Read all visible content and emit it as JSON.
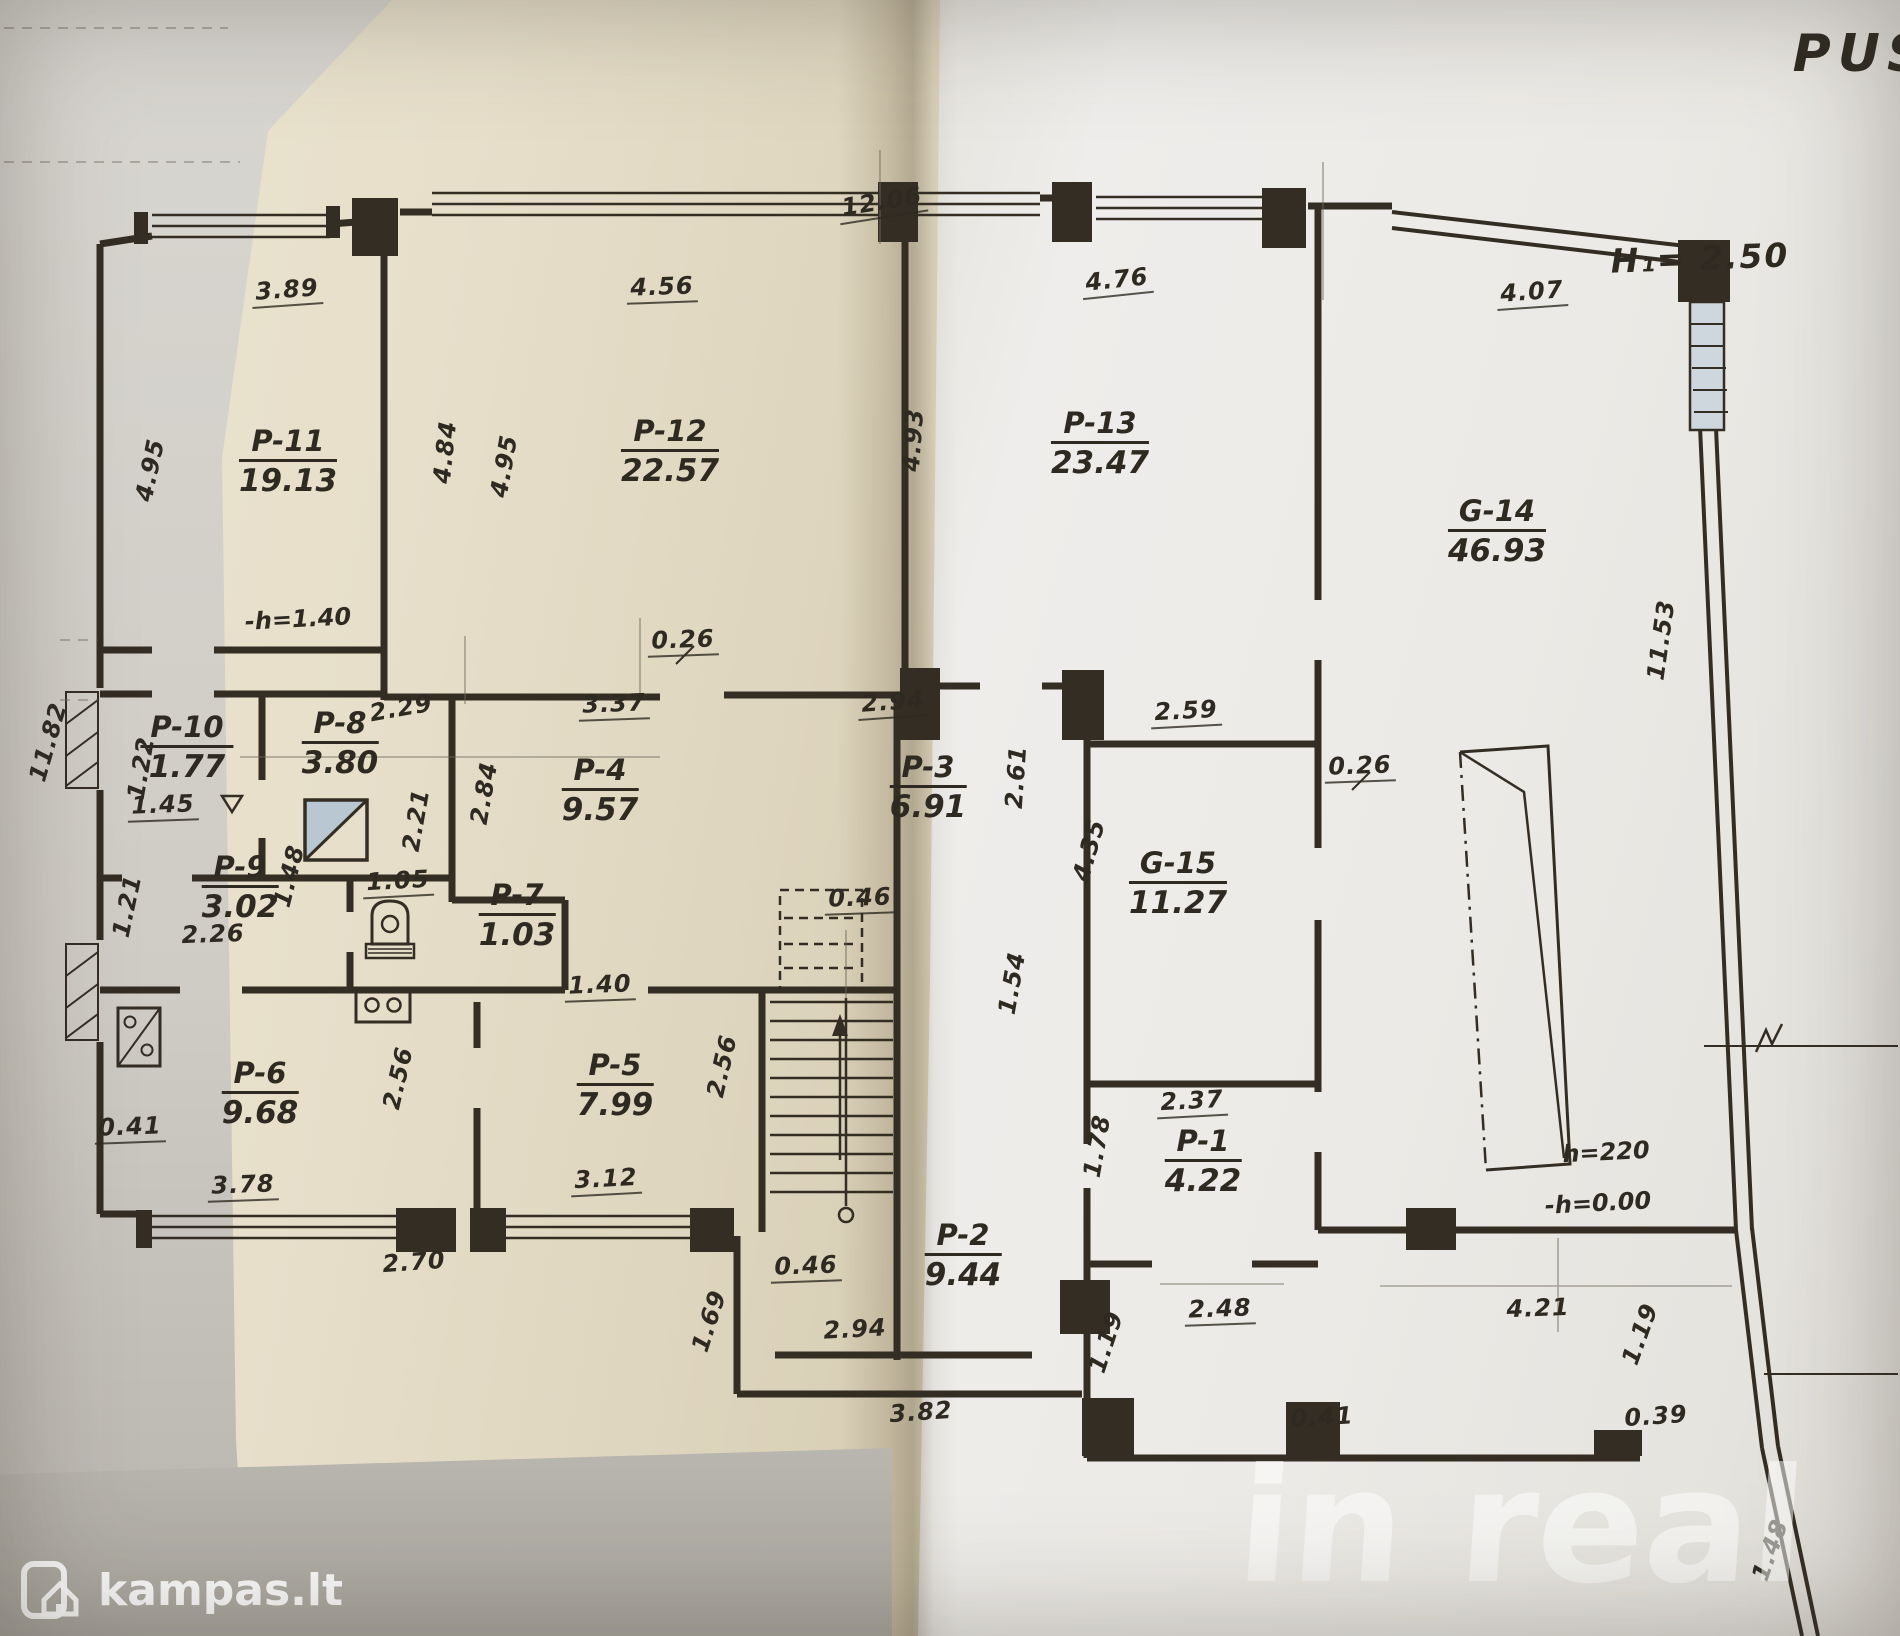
{
  "annotations": [
    {
      "t": "-h=1.40",
      "x": 298,
      "y": 619,
      "r": -3,
      "cls": "mid"
    },
    {
      "t": "h=220",
      "x": 1606,
      "y": 1152,
      "r": -3,
      "cls": "mid"
    },
    {
      "t": "-h=0.00",
      "x": 1598,
      "y": 1203,
      "r": -3,
      "cls": "mid"
    },
    {
      "t": "H₁= 2.50",
      "x": 1700,
      "y": 258,
      "r": -2,
      "cls": "big"
    },
    {
      "t": "PUS",
      "x": 1862,
      "y": 54,
      "r": 0,
      "cls": "title"
    }
  ],
  "rooms": [
    {
      "name": "P-11",
      "area": "19.13",
      "x": 288,
      "y": 462
    },
    {
      "name": "P-12",
      "area": "22.57",
      "x": 670,
      "y": 452
    },
    {
      "name": "P-13",
      "area": "23.47",
      "x": 1100,
      "y": 444
    },
    {
      "name": "G-14",
      "area": "46.93",
      "x": 1497,
      "y": 532
    },
    {
      "name": "P-10",
      "area": "1.77",
      "x": 187,
      "y": 748
    },
    {
      "name": "P-8",
      "area": "3.80",
      "x": 340,
      "y": 744
    },
    {
      "name": "P-9",
      "area": "3.02",
      "x": 240,
      "y": 888
    },
    {
      "name": "P-4",
      "area": "9.57",
      "x": 600,
      "y": 791
    },
    {
      "name": "P-7",
      "area": "1.03",
      "x": 517,
      "y": 916
    },
    {
      "name": "P-3",
      "area": "6.91",
      "x": 928,
      "y": 788
    },
    {
      "name": "G-15",
      "area": "11.27",
      "x": 1178,
      "y": 884
    },
    {
      "name": "P-6",
      "area": "9.68",
      "x": 260,
      "y": 1094
    },
    {
      "name": "P-5",
      "area": "7.99",
      "x": 615,
      "y": 1086
    },
    {
      "name": "P-1",
      "area": "4.22",
      "x": 1203,
      "y": 1162
    },
    {
      "name": "P-2",
      "area": "9.44",
      "x": 963,
      "y": 1256
    }
  ],
  "dims": [
    {
      "t": "3.89",
      "x": 287,
      "y": 291,
      "r": -4,
      "u": true
    },
    {
      "t": "4.56",
      "x": 662,
      "y": 288,
      "r": -2,
      "u": true
    },
    {
      "t": "12.06",
      "x": 882,
      "y": 203,
      "r": -9,
      "u": true
    },
    {
      "t": "4.76",
      "x": 1117,
      "y": 281,
      "r": -6,
      "u": true
    },
    {
      "t": "4.07",
      "x": 1532,
      "y": 293,
      "r": -4,
      "u": true
    },
    {
      "t": "4.95",
      "x": 150,
      "y": 470,
      "r": -78,
      "u": false
    },
    {
      "t": "4.84",
      "x": 445,
      "y": 452,
      "r": -84,
      "u": false
    },
    {
      "t": "4.95",
      "x": 504,
      "y": 466,
      "r": -80,
      "u": false
    },
    {
      "t": "4.93",
      "x": 913,
      "y": 440,
      "r": -86,
      "u": false
    },
    {
      "t": "11.53",
      "x": 1661,
      "y": 640,
      "r": -82,
      "u": false
    },
    {
      "t": "11.82",
      "x": 48,
      "y": 742,
      "r": -74,
      "u": false
    },
    {
      "t": "0.26",
      "x": 683,
      "y": 641,
      "r": -2,
      "u": true
    },
    {
      "t": "3.37",
      "x": 614,
      "y": 705,
      "r": -2,
      "u": true
    },
    {
      "t": "2.94",
      "x": 893,
      "y": 703,
      "r": -4,
      "u": true
    },
    {
      "t": "2.29",
      "x": 401,
      "y": 708,
      "r": -10,
      "u": false
    },
    {
      "t": "2.21",
      "x": 416,
      "y": 820,
      "r": -80,
      "u": false
    },
    {
      "t": "2.84",
      "x": 484,
      "y": 793,
      "r": -80,
      "u": false
    },
    {
      "t": "1.22",
      "x": 141,
      "y": 768,
      "r": -80,
      "u": false
    },
    {
      "t": "1.45",
      "x": 163,
      "y": 806,
      "r": -2,
      "u": true
    },
    {
      "t": "1.21",
      "x": 127,
      "y": 906,
      "r": -78,
      "u": false
    },
    {
      "t": "1.48",
      "x": 289,
      "y": 876,
      "r": -76,
      "u": false
    },
    {
      "t": "1.05",
      "x": 398,
      "y": 882,
      "r": -3,
      "u": true
    },
    {
      "t": "2.26",
      "x": 213,
      "y": 934,
      "r": -2,
      "u": false
    },
    {
      "t": "2.61",
      "x": 1016,
      "y": 777,
      "r": -86,
      "u": false
    },
    {
      "t": "2.59",
      "x": 1186,
      "y": 712,
      "r": -3,
      "u": true
    },
    {
      "t": "0.26",
      "x": 1360,
      "y": 767,
      "r": -2,
      "u": true
    },
    {
      "t": "4.35",
      "x": 1089,
      "y": 850,
      "r": -74,
      "u": false
    },
    {
      "t": "1.54",
      "x": 1012,
      "y": 983,
      "r": -80,
      "u": false
    },
    {
      "t": "0.46",
      "x": 860,
      "y": 899,
      "r": -2,
      "u": true
    },
    {
      "t": "1.40",
      "x": 600,
      "y": 986,
      "r": -2,
      "u": true
    },
    {
      "t": "2.56",
      "x": 398,
      "y": 1078,
      "r": -77,
      "u": false
    },
    {
      "t": "2.56",
      "x": 722,
      "y": 1066,
      "r": -77,
      "u": false
    },
    {
      "t": "0.41",
      "x": 130,
      "y": 1128,
      "r": -2,
      "u": true
    },
    {
      "t": "3.78",
      "x": 243,
      "y": 1186,
      "r": -2,
      "u": true
    },
    {
      "t": "3.12",
      "x": 606,
      "y": 1180,
      "r": -3,
      "u": true
    },
    {
      "t": "2.70",
      "x": 414,
      "y": 1262,
      "r": -4,
      "u": false
    },
    {
      "t": "1.69",
      "x": 709,
      "y": 1321,
      "r": -72,
      "u": false
    },
    {
      "t": "0.46",
      "x": 806,
      "y": 1267,
      "r": -2,
      "u": true
    },
    {
      "t": "2.94",
      "x": 855,
      "y": 1329,
      "r": -3,
      "u": false
    },
    {
      "t": "3.82",
      "x": 921,
      "y": 1412,
      "r": -4,
      "u": false
    },
    {
      "t": "2.37",
      "x": 1192,
      "y": 1102,
      "r": -3,
      "u": true
    },
    {
      "t": "1.78",
      "x": 1097,
      "y": 1146,
      "r": -80,
      "u": false
    },
    {
      "t": "2.48",
      "x": 1220,
      "y": 1310,
      "r": -2,
      "u": true
    },
    {
      "t": "1.19",
      "x": 1106,
      "y": 1342,
      "r": -72,
      "u": false
    },
    {
      "t": "4.21",
      "x": 1538,
      "y": 1308,
      "r": -2,
      "u": false
    },
    {
      "t": "1.19",
      "x": 1640,
      "y": 1334,
      "r": -70,
      "u": false
    },
    {
      "t": "0.41",
      "x": 1322,
      "y": 1417,
      "r": -3,
      "u": false
    },
    {
      "t": "0.39",
      "x": 1656,
      "y": 1416,
      "r": -4,
      "u": false
    },
    {
      "t": "1.48",
      "x": 1770,
      "y": 1550,
      "r": -70,
      "u": false
    }
  ],
  "watermarks": {
    "kampas": "kampas.lt",
    "inreal": "in real"
  },
  "colors": {
    "ink": "#332d24",
    "paper_left": "#e7dfca",
    "paper_right": "#edecea",
    "chimney_fill": "#b9c7d2",
    "watermark_white": "#ffffff"
  },
  "icons": [
    "toilet-icon",
    "stove-icon",
    "boiler-icon",
    "chimney-icon",
    "vent-triangle-icon",
    "window-hatch",
    "stairs-up-arrow",
    "section-marker",
    "kampas-logo-icon"
  ]
}
